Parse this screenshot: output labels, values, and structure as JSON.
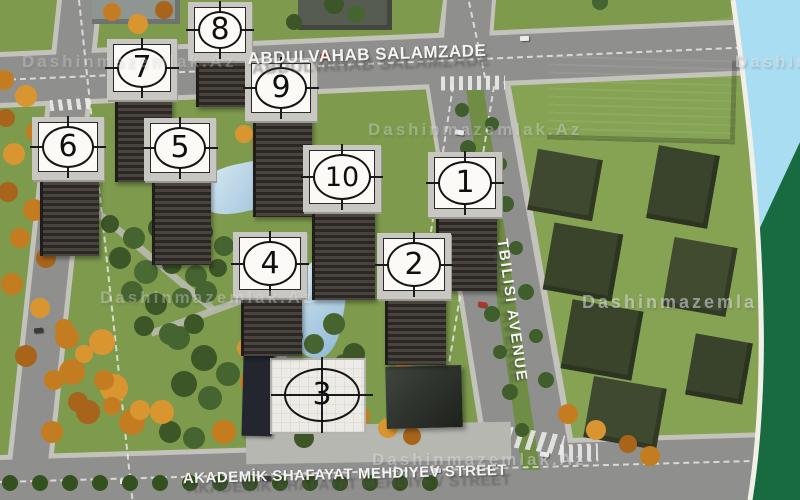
{
  "streets": {
    "top": "ABDULVAHAB SALAMZADE",
    "bottom": "AKADEMİK SHAFAYAT MEHDIYEV STREET",
    "right": "TBILISI AVENUE"
  },
  "watermark": "Dashinmazemlak.Az",
  "buildings": [
    {
      "number": "1"
    },
    {
      "number": "2"
    },
    {
      "number": "3"
    },
    {
      "number": "4"
    },
    {
      "number": "5"
    },
    {
      "number": "6"
    },
    {
      "number": "7"
    },
    {
      "number": "8"
    },
    {
      "number": "9"
    },
    {
      "number": "10"
    }
  ],
  "colors": {
    "grass": "#7d9a4d",
    "road": "#8f908e",
    "water_band": "#a9ddf2",
    "forest_band": "#186a40",
    "plate": "#fbfaf7"
  }
}
